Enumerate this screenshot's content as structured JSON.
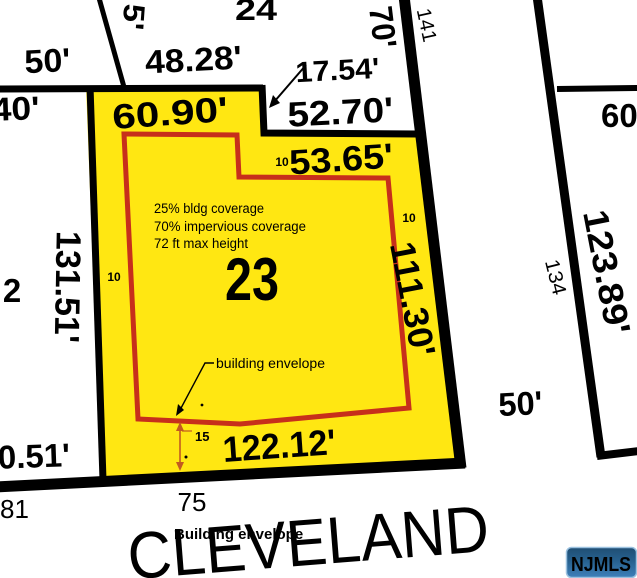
{
  "street": {
    "name": "CLEVELAND"
  },
  "watermark": {
    "text": "NJMLS"
  },
  "colors": {
    "lot_fill": "#FFE712",
    "boundary_black": "#000000",
    "envelope_red": "#C72F1B",
    "note_red": "#CC4420",
    "caption_red": "#C33826",
    "setback_orange": "#C25A20",
    "setback_gold": "#A58428",
    "badge_text": "#FFFFFF",
    "badge_border": "#9CC2E0"
  },
  "parcel": {
    "lot_number": "23",
    "zoning_notes": [
      "25% bldg coverage",
      "70% impervious coverage",
      "72 ft max height"
    ],
    "envelope_callout": "building envelope",
    "envelope_caption": "Building envelope"
  },
  "dimensions": {
    "top_50": "50'",
    "d48_28": "48.28'",
    "d5": "5'",
    "d70": "70'",
    "d17_54": "17.54'",
    "d52_70": "52.70'",
    "d40": "40'",
    "d60_90": "60.90'",
    "d53_65": "53.65'",
    "d131_51": "131.51'",
    "d111_30": "111.30'",
    "d123_89": "123.89'",
    "d122_12": "122.12'",
    "d0_51": "0.51'",
    "right_50": "50'",
    "d60": "60"
  },
  "setbacks": {
    "side_10_left": "10",
    "top_10": "10",
    "right_10": "10",
    "front_15": "15"
  },
  "adjacent_lots": {
    "lot_24": "24",
    "lot_2": "2",
    "lot_141": "141",
    "lot_134": "134",
    "lot_81": "81",
    "lot_75": "75"
  }
}
